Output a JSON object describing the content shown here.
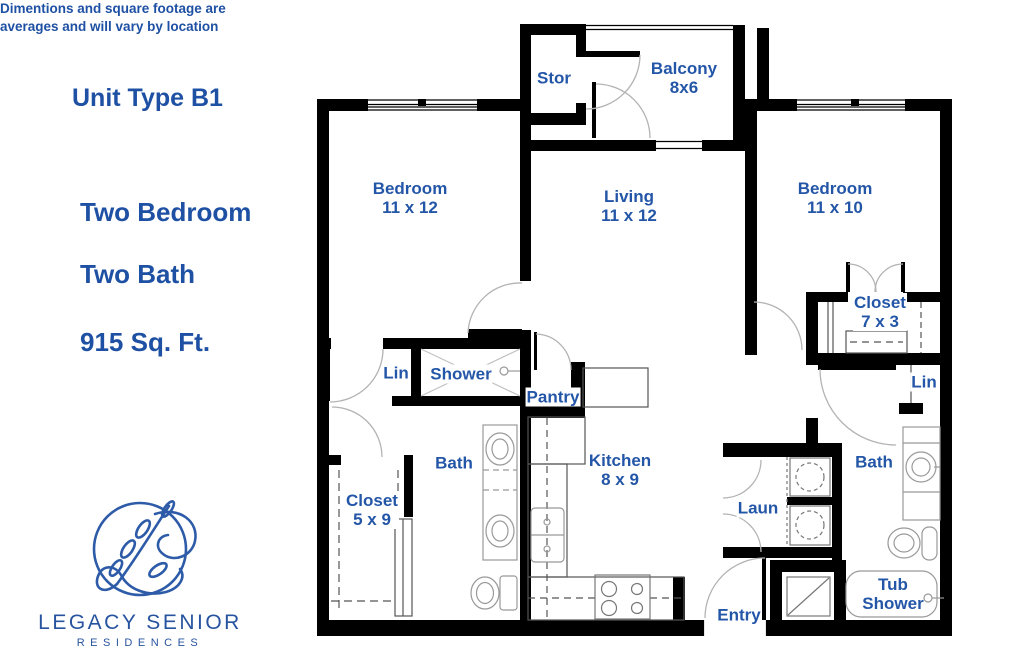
{
  "panel": {
    "unit_type": "Unit Type B1",
    "config_line1": "Two Bedroom",
    "config_line2": "Two Bath",
    "area": "915 Sq. Ft.",
    "disclaimer_line1": "Dimentions and square footage are",
    "disclaimer_line2": "averages and will vary by location",
    "brand": {
      "name": "LEGACY SENIOR",
      "sub": "RESIDENCES"
    }
  },
  "rooms": {
    "stor": {
      "name": "Stor"
    },
    "balcony": {
      "name": "Balcony",
      "dims": "8x6"
    },
    "bedroom1": {
      "name": "Bedroom",
      "dims": "11 x 12"
    },
    "living": {
      "name": "Living",
      "dims": "11 x 12"
    },
    "bedroom2": {
      "name": "Bedroom",
      "dims": "11 x 10"
    },
    "closet2": {
      "name": "Closet",
      "dims": "7 x 3"
    },
    "lin1": {
      "name": "Lin"
    },
    "lin2": {
      "name": "Lin"
    },
    "shower": {
      "name": "Shower"
    },
    "pantry": {
      "name": "Pantry"
    },
    "bath1": {
      "name": "Bath"
    },
    "bath2": {
      "name": "Bath"
    },
    "kitchen": {
      "name": "Kitchen",
      "dims": "8 x 9"
    },
    "closet1": {
      "name": "Closet",
      "dims": "5 x 9"
    },
    "laundry": {
      "name": "Laun"
    },
    "entry": {
      "name": "Entry"
    },
    "tub": {
      "name": "Tub",
      "dims": "Shower"
    }
  },
  "colors": {
    "accent": "#2456a8",
    "heading": "#1e50a3",
    "wall": "#000000",
    "door_arc": "#b3b3b3",
    "fixture": "#999999"
  }
}
